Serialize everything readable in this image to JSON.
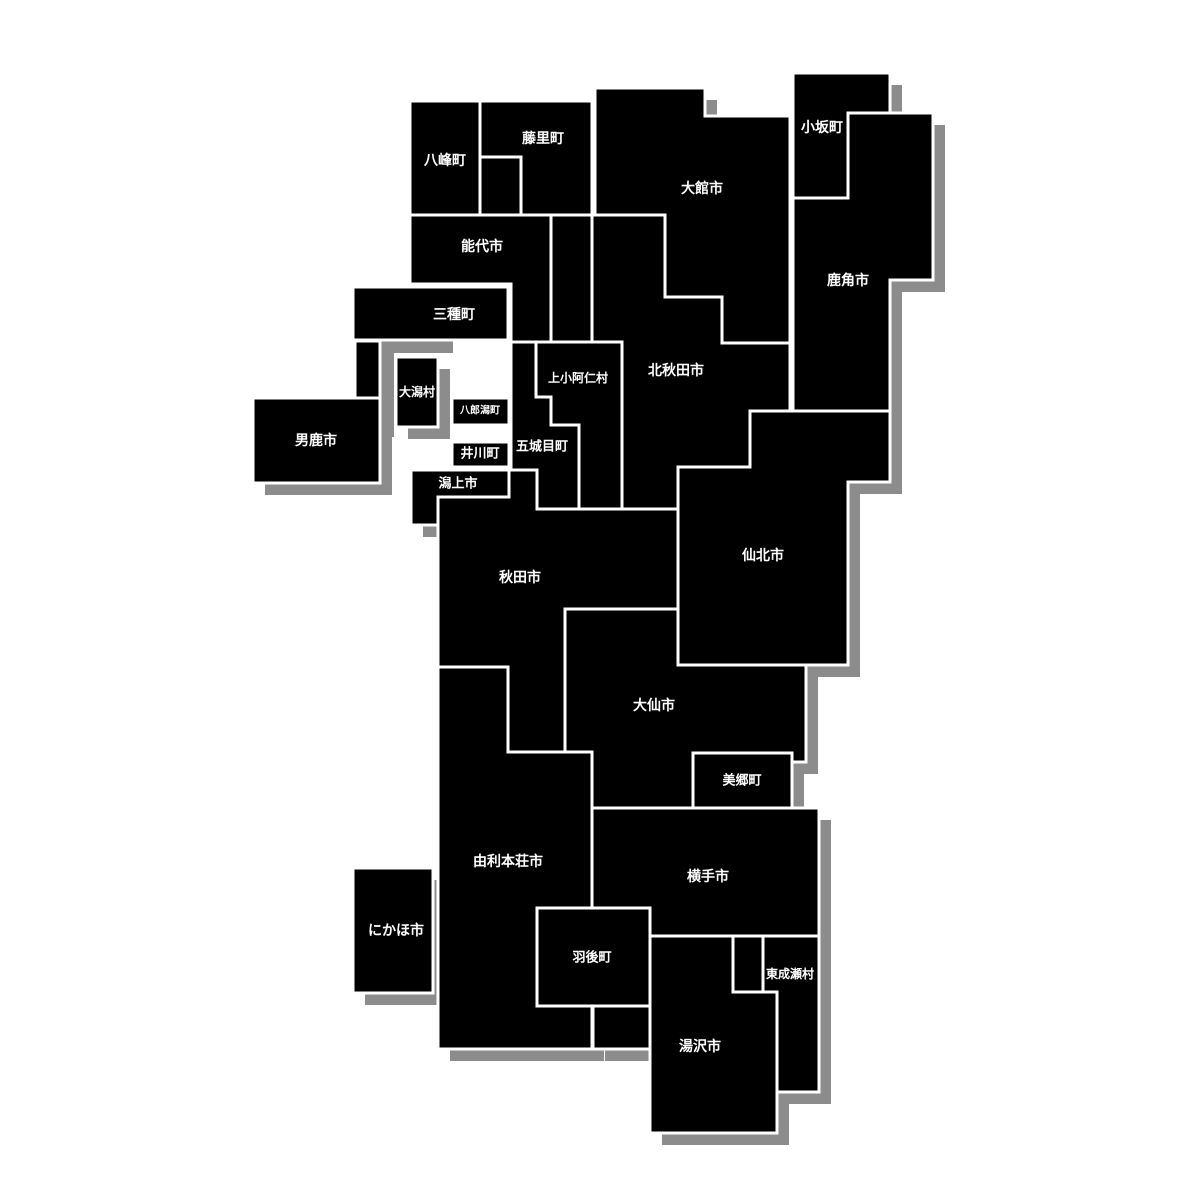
{
  "map": {
    "canvas": {
      "width": 1200,
      "height": 1200,
      "background": "#ffffff"
    },
    "style": {
      "block_fill": "#000000",
      "border_color": "#ffffff",
      "border_width": 3,
      "shadow_color": "#8c8c8c",
      "shadow_dx": 12,
      "shadow_dy": 12,
      "label_color": "#ffffff"
    },
    "lake": {
      "id": "hachirogata-lake-area",
      "color": "#8c8c8c",
      "points": [
        [
          381,
          341
        ],
        [
          453,
          341
        ],
        [
          453,
          353
        ],
        [
          394,
          353
        ],
        [
          394,
          437
        ],
        [
          381,
          437
        ]
      ]
    },
    "municipalities": [
      {
        "id": "happo",
        "label": "八峰町",
        "label_x": 445,
        "label_y": 161,
        "font_size": 14,
        "shadow": true,
        "points": [
          [
            410,
            101
          ],
          [
            480,
            101
          ],
          [
            480,
            215
          ],
          [
            410,
            215
          ]
        ]
      },
      {
        "id": "fujisato",
        "label": "藤里町",
        "label_x": 543,
        "label_y": 139,
        "font_size": 14,
        "shadow": true,
        "points": [
          [
            480,
            101
          ],
          [
            592,
            101
          ],
          [
            592,
            215
          ],
          [
            521,
            215
          ],
          [
            521,
            157
          ],
          [
            480,
            157
          ]
        ]
      },
      {
        "id": "unlabeled-a",
        "label": "",
        "label_x": 500,
        "label_y": 186,
        "font_size": 0,
        "shadow": true,
        "points": [
          [
            480,
            157
          ],
          [
            521,
            157
          ],
          [
            521,
            215
          ],
          [
            480,
            215
          ]
        ]
      },
      {
        "id": "noshiro",
        "label": "能代市",
        "label_x": 482,
        "label_y": 247,
        "font_size": 14,
        "shadow": true,
        "points": [
          [
            410,
            215
          ],
          [
            551,
            215
          ],
          [
            551,
            342
          ],
          [
            511,
            342
          ],
          [
            511,
            284
          ],
          [
            410,
            284
          ]
        ]
      },
      {
        "id": "unlabeled-b",
        "label": "",
        "label_x": 571,
        "label_y": 278,
        "font_size": 0,
        "shadow": true,
        "points": [
          [
            551,
            215
          ],
          [
            592,
            215
          ],
          [
            592,
            342
          ],
          [
            551,
            342
          ]
        ]
      },
      {
        "id": "odate",
        "label": "大館市",
        "label_x": 702,
        "label_y": 189,
        "font_size": 14,
        "shadow": true,
        "points": [
          [
            595,
            88
          ],
          [
            705,
            88
          ],
          [
            705,
            116
          ],
          [
            790,
            116
          ],
          [
            790,
            343
          ],
          [
            722,
            343
          ],
          [
            722,
            297
          ],
          [
            665,
            297
          ],
          [
            665,
            215
          ],
          [
            595,
            215
          ]
        ]
      },
      {
        "id": "kosaka",
        "label": "小坂町",
        "label_x": 822,
        "label_y": 128,
        "font_size": 14,
        "shadow": true,
        "points": [
          [
            793,
            73
          ],
          [
            890,
            73
          ],
          [
            890,
            113
          ],
          [
            848,
            113
          ],
          [
            848,
            198
          ],
          [
            793,
            198
          ]
        ]
      },
      {
        "id": "kazuno",
        "label": "鹿角市",
        "label_x": 848,
        "label_y": 281,
        "font_size": 14,
        "shadow": true,
        "points": [
          [
            848,
            113
          ],
          [
            933,
            113
          ],
          [
            933,
            280
          ],
          [
            890,
            280
          ],
          [
            890,
            411
          ],
          [
            793,
            411
          ],
          [
            793,
            198
          ],
          [
            848,
            198
          ]
        ]
      },
      {
        "id": "kitaakita",
        "label": "北秋田市",
        "label_x": 676,
        "label_y": 371,
        "font_size": 14,
        "shadow": true,
        "points": [
          [
            592,
            215
          ],
          [
            665,
            215
          ],
          [
            665,
            297
          ],
          [
            722,
            297
          ],
          [
            722,
            343
          ],
          [
            790,
            343
          ],
          [
            790,
            411
          ],
          [
            750,
            411
          ],
          [
            750,
            467
          ],
          [
            678,
            467
          ],
          [
            678,
            509
          ],
          [
            622,
            509
          ],
          [
            622,
            342
          ],
          [
            592,
            342
          ]
        ]
      },
      {
        "id": "mitane",
        "label": "三種町",
        "label_x": 454,
        "label_y": 315,
        "font_size": 14,
        "shadow": false,
        "points": [
          [
            353,
            287
          ],
          [
            508,
            287
          ],
          [
            508,
            340
          ],
          [
            353,
            340
          ]
        ]
      },
      {
        "id": "unlabeled-e",
        "label": "",
        "label_x": 367,
        "label_y": 369,
        "font_size": 0,
        "shadow": true,
        "points": [
          [
            355,
            341
          ],
          [
            380,
            341
          ],
          [
            380,
            398
          ],
          [
            355,
            398
          ]
        ]
      },
      {
        "id": "ogata",
        "label": "大潟村",
        "label_x": 417,
        "label_y": 392,
        "font_size": 12,
        "shadow": true,
        "points": [
          [
            396,
            357
          ],
          [
            438,
            357
          ],
          [
            438,
            427
          ],
          [
            396,
            427
          ]
        ]
      },
      {
        "id": "kamikoani",
        "label": "上小阿仁村",
        "label_x": 578,
        "label_y": 378,
        "font_size": 12,
        "shadow": true,
        "points": [
          [
            536,
            342
          ],
          [
            622,
            342
          ],
          [
            622,
            509
          ],
          [
            579,
            509
          ],
          [
            579,
            425
          ],
          [
            551,
            425
          ],
          [
            551,
            397
          ],
          [
            536,
            397
          ]
        ]
      },
      {
        "id": "gojome",
        "label": "五城目町",
        "label_x": 542,
        "label_y": 447,
        "font_size": 13,
        "shadow": true,
        "points": [
          [
            511,
            342
          ],
          [
            536,
            342
          ],
          [
            536,
            397
          ],
          [
            551,
            397
          ],
          [
            551,
            425
          ],
          [
            579,
            425
          ],
          [
            579,
            509
          ],
          [
            537,
            509
          ],
          [
            537,
            470
          ],
          [
            511,
            470
          ]
        ]
      },
      {
        "id": "hachirogata",
        "label": "八郎潟町",
        "label_x": 480,
        "label_y": 411,
        "font_size": 10,
        "shadow": false,
        "points": [
          [
            452,
            398
          ],
          [
            509,
            398
          ],
          [
            509,
            425
          ],
          [
            452,
            425
          ]
        ]
      },
      {
        "id": "ikawa",
        "label": "井川町",
        "label_x": 480,
        "label_y": 454,
        "font_size": 13,
        "shadow": true,
        "points": [
          [
            452,
            442
          ],
          [
            509,
            442
          ],
          [
            509,
            467
          ],
          [
            452,
            467
          ]
        ]
      },
      {
        "id": "oga",
        "label": "男鹿市",
        "label_x": 316,
        "label_y": 441,
        "font_size": 14,
        "shadow": true,
        "points": [
          [
            253,
            398
          ],
          [
            380,
            398
          ],
          [
            380,
            483
          ],
          [
            253,
            483
          ]
        ]
      },
      {
        "id": "katagami",
        "label": "潟上市",
        "label_x": 458,
        "label_y": 484,
        "font_size": 13,
        "shadow": true,
        "points": [
          [
            411,
            470
          ],
          [
            509,
            470
          ],
          [
            509,
            497
          ],
          [
            438,
            497
          ],
          [
            438,
            525
          ],
          [
            411,
            525
          ]
        ]
      },
      {
        "id": "akita",
        "label": "秋田市",
        "label_x": 520,
        "label_y": 578,
        "font_size": 14,
        "shadow": true,
        "points": [
          [
            438,
            497
          ],
          [
            509,
            497
          ],
          [
            509,
            470
          ],
          [
            537,
            470
          ],
          [
            537,
            509
          ],
          [
            678,
            509
          ],
          [
            678,
            609
          ],
          [
            565,
            609
          ],
          [
            565,
            752
          ],
          [
            508,
            752
          ],
          [
            508,
            667
          ],
          [
            438,
            667
          ]
        ]
      },
      {
        "id": "senboku",
        "label": "仙北市",
        "label_x": 763,
        "label_y": 556,
        "font_size": 14,
        "shadow": true,
        "points": [
          [
            750,
            411
          ],
          [
            890,
            411
          ],
          [
            890,
            482
          ],
          [
            848,
            482
          ],
          [
            848,
            665
          ],
          [
            678,
            665
          ],
          [
            678,
            467
          ],
          [
            750,
            467
          ]
        ]
      },
      {
        "id": "daisen",
        "label": "大仙市",
        "label_x": 654,
        "label_y": 706,
        "font_size": 14,
        "shadow": true,
        "points": [
          [
            565,
            609
          ],
          [
            678,
            609
          ],
          [
            678,
            665
          ],
          [
            806,
            665
          ],
          [
            806,
            762
          ],
          [
            792,
            762
          ],
          [
            792,
            753
          ],
          [
            693,
            753
          ],
          [
            693,
            808
          ],
          [
            592,
            808
          ],
          [
            592,
            752
          ],
          [
            565,
            752
          ]
        ]
      },
      {
        "id": "misato",
        "label": "美郷町",
        "label_x": 742,
        "label_y": 781,
        "font_size": 13,
        "shadow": true,
        "points": [
          [
            693,
            753
          ],
          [
            792,
            753
          ],
          [
            792,
            808
          ],
          [
            693,
            808
          ]
        ]
      },
      {
        "id": "yurihonjo",
        "label": "由利本荘市",
        "label_x": 508,
        "label_y": 862,
        "font_size": 14,
        "shadow": true,
        "points": [
          [
            438,
            667
          ],
          [
            508,
            667
          ],
          [
            508,
            752
          ],
          [
            592,
            752
          ],
          [
            592,
            908
          ],
          [
            537,
            908
          ],
          [
            537,
            1006
          ],
          [
            592,
            1006
          ],
          [
            592,
            1049
          ],
          [
            438,
            1049
          ]
        ]
      },
      {
        "id": "yokote",
        "label": "横手市",
        "label_x": 708,
        "label_y": 877,
        "font_size": 14,
        "shadow": true,
        "points": [
          [
            592,
            808
          ],
          [
            819,
            808
          ],
          [
            819,
            936
          ],
          [
            650,
            936
          ],
          [
            650,
            908
          ],
          [
            592,
            908
          ]
        ]
      },
      {
        "id": "nikaho",
        "label": "にかほ市",
        "label_x": 396,
        "label_y": 931,
        "font_size": 14,
        "shadow": true,
        "points": [
          [
            353,
            868
          ],
          [
            433,
            868
          ],
          [
            433,
            993
          ],
          [
            353,
            993
          ]
        ]
      },
      {
        "id": "ugo",
        "label": "羽後町",
        "label_x": 592,
        "label_y": 958,
        "font_size": 13,
        "shadow": true,
        "points": [
          [
            537,
            908
          ],
          [
            650,
            908
          ],
          [
            650,
            1006
          ],
          [
            537,
            1006
          ]
        ]
      },
      {
        "id": "unlabeled-d",
        "label": "",
        "label_x": 621,
        "label_y": 1027,
        "font_size": 0,
        "shadow": true,
        "points": [
          [
            593,
            1006
          ],
          [
            650,
            1006
          ],
          [
            650,
            1049
          ],
          [
            593,
            1049
          ]
        ]
      },
      {
        "id": "unlabeled-c",
        "label": "",
        "label_x": 748,
        "label_y": 964,
        "font_size": 0,
        "shadow": true,
        "points": [
          [
            733,
            936
          ],
          [
            763,
            936
          ],
          [
            763,
            992
          ],
          [
            733,
            992
          ]
        ]
      },
      {
        "id": "higashinaruse",
        "label": "東成瀬村",
        "label_x": 790,
        "label_y": 974,
        "font_size": 12,
        "shadow": true,
        "points": [
          [
            763,
            936
          ],
          [
            819,
            936
          ],
          [
            819,
            1092
          ],
          [
            777,
            1092
          ],
          [
            777,
            992
          ],
          [
            763,
            992
          ]
        ]
      },
      {
        "id": "yuzawa",
        "label": "湯沢市",
        "label_x": 700,
        "label_y": 1047,
        "font_size": 14,
        "shadow": true,
        "points": [
          [
            650,
            936
          ],
          [
            733,
            936
          ],
          [
            733,
            992
          ],
          [
            777,
            992
          ],
          [
            777,
            1133
          ],
          [
            650,
            1133
          ]
        ]
      }
    ]
  }
}
